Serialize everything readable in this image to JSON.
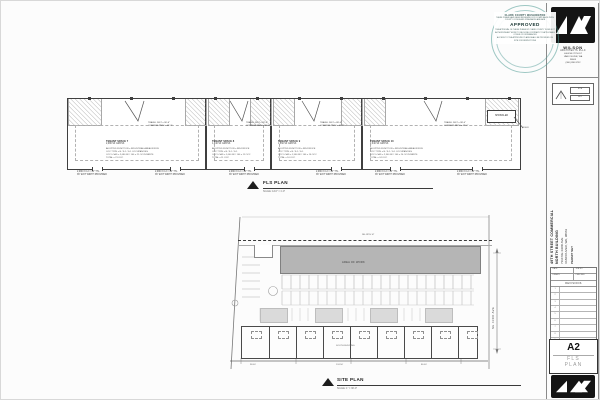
{
  "stamp": {
    "county": "CLARK COUNTY WASHINGTON",
    "review": "THESE PLANS HAVE BEEN REVIEWED FOR COMPLIANCE WITH COUNTY CODES AND STANDARDS AND ARE",
    "approved": "APPROVED",
    "disclaimer": "THE APPROVAL OF THESE PLANS BY CLARK COUNTY DOES NOT AUTHORIZE ANY WORK TO BE DONE CONTRARY TO APPLICABLE CODES OR ORDINANCES",
    "access": "ACCESS TO THE APPROVED PLANS SHALL BE PROVIDED ON SITE FOR INSPECTIONS"
  },
  "architect": {
    "firm": "WILSON",
    "firm2": "ARCHITECTS PLLC",
    "address1": "4404 NE 78TH ST",
    "address2": "VANCOUVER, WA",
    "address3": "98665",
    "phone": "(360) 896-9732"
  },
  "permitbox": {
    "tag1": "SITE",
    "tag2": "KEY"
  },
  "floorplan": {
    "title": "FLS PLAN",
    "scale": "SCALE: 1/16\" = 1'-0\"",
    "sprinkler": "SPRINKLER",
    "riser": "RISER",
    "exit_note1": "2,080 X 0.2 = 14\" TTL",
    "exit_note2": "36\" EXIT WIDTH PROVIDED",
    "units": [
      {
        "name": "TENANT SPACE 7",
        "area": "2,080 SF GROSS",
        "travel1": "TRAVEL DIST = 96'-6\"",
        "travel2": "COMMON PATH = 48'-3\"",
        "info": [
          "ADOPTED FUNCTION = INDUSTRIAL AREA/OFFICE",
          "OCC TYPE = B / F-1 / S-1 OCCUPANCIES",
          "OCC LOAD = 2,080 SF / 100 = 21 OCCUPANTS",
          "TOTAL = 21 OCC"
        ]
      },
      {
        "name": "TENANT SPACE 8",
        "area": "1,040 SF GROSS",
        "travel1": "TRAVEL DIST = 82'-0\"",
        "travel2": "COMMON PATH = 41'-0\"",
        "info": [
          "ADOPTED FUNCTION = IND/OFFICE",
          "OCC TYPE = B / F-1 / S-1",
          "OCC LOAD = 1,040 SF / 100 = 11 OCC",
          "TOTAL = 11 OCC"
        ]
      },
      {
        "name": "TENANT SPACE 9",
        "area": "1,560 SF GROSS",
        "travel1": "TRAVEL DIST = 88'-4\"",
        "travel2": "COMMON PATH = 44'-2\"",
        "info": [
          "ADOPTED FUNCTION = IND/OFFICE",
          "OCC TYPE = B / F-1 / S-1",
          "OCC LOAD = 1,560 SF / 100 = 16 OCC",
          "TOTAL = 16 OCC"
        ]
      },
      {
        "name": "TENANT SPACE 10",
        "area": "2,340 SF GROSS",
        "travel1": "TRAVEL DIST = 98'-0\"",
        "travel2": "COMMON PATH = 49'-0\"",
        "info": [
          "ADOPTED FUNCTION = INDUSTRIAL AREA/OFFICE",
          "OCC TYPE = B / F-1 / S-1 OCCUPANCIES",
          "OCC LOAD = 2,340 SF / 100 = 24 OCCUPANTS",
          "TOTAL = 24 OCC"
        ]
      }
    ]
  },
  "siteplan": {
    "title": "SITE PLAN",
    "scale": "SCALE: 1\" = 30'-0\"",
    "area_of_work": "AREA OF WORK",
    "street_top": "NE 49TH ST",
    "street_right": "NE 43RD AVE",
    "south_building": "SOUTH BUILDING",
    "dims": [
      "98.00'",
      "124.50'",
      "86.00'"
    ]
  },
  "titleblock": {
    "project": [
      "49TH STREET COMMERCIAL",
      "NORTH BUILDING",
      "7110 NE 43RD AVE",
      "VANCOUVER, WA, 98661",
      "PERMIT SET"
    ],
    "table": {
      "date": "DATE",
      "drawn": "DRAWN",
      "job": "JOB NO",
      "checked": "CHECKED",
      "revisions": "REVISIONS",
      "rows": [
        "1",
        "2",
        "3",
        "4",
        "5",
        "6",
        "7",
        "8",
        "9"
      ]
    },
    "sheet_number": "A2",
    "sheet_name_1": "FLS",
    "sheet_name_2": "PLAN"
  },
  "colors": {
    "seal": "#4e9a94",
    "area_fill": "#b5b5b5",
    "logo_bg": "#141414"
  }
}
